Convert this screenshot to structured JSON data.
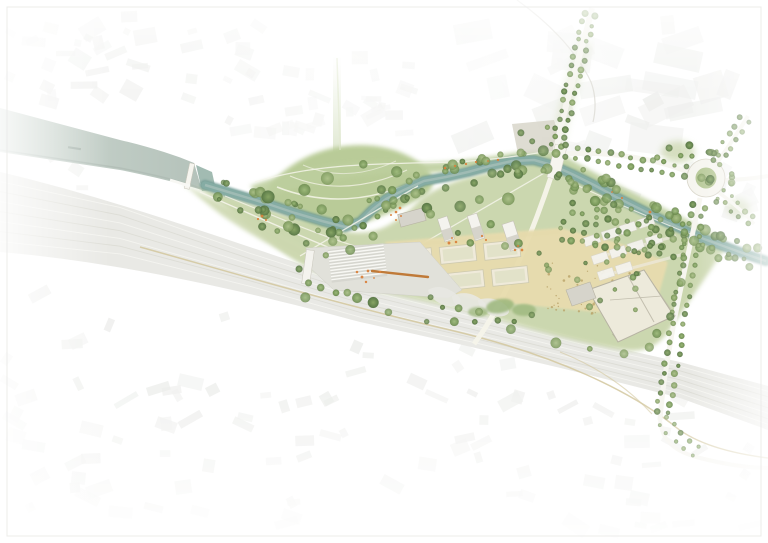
{
  "plan": {
    "kind": "landscape-masterplan",
    "features": [
      {
        "name": "city-fabric",
        "fill_key": "city_block"
      },
      {
        "name": "wide-canal",
        "fill_key": "canal_water"
      },
      {
        "name": "weir-lock-gate",
        "fill_key": "road"
      },
      {
        "name": "river",
        "fill_key": "river_core"
      },
      {
        "name": "river-bank-trees",
        "fill_key": "tree_mid"
      },
      {
        "name": "park-meadow",
        "fill_key": "park_green"
      },
      {
        "name": "event-lawn-with-arc-paths",
        "fill_key": "lawn_green"
      },
      {
        "name": "railway-corridor",
        "fill_key": "rail_band"
      },
      {
        "name": "plaza-with-grandstand-steps",
        "fill_key": "plaza"
      },
      {
        "name": "sand-area-with-courts",
        "fill_key": "sand"
      },
      {
        "name": "sports-courts",
        "fill_key": "court_fill"
      },
      {
        "name": "scatter-grove",
        "fill_key": "sand_dot"
      },
      {
        "name": "sports-hall",
        "fill_key": "building_fill"
      },
      {
        "name": "pavilion-buildings",
        "fill_key": "building_white"
      },
      {
        "name": "parking-rows",
        "fill_key": "building_white"
      },
      {
        "name": "orchard-grid",
        "fill_key": "tree_light"
      },
      {
        "name": "skatepark-landforms",
        "fill_key": "skate"
      },
      {
        "name": "bridge",
        "fill_key": "road"
      },
      {
        "name": "tree-lined-avenues",
        "fill_key": "road"
      },
      {
        "name": "roundabout",
        "fill_key": "roundabout_green"
      },
      {
        "name": "orange-furniture-accents",
        "fill_key": "orange"
      }
    ]
  },
  "palette": {
    "bg": "#ffffff",
    "city_block": "#e4e5e1",
    "city_block_dark": "#dcded9",
    "wash": "#ffffff",
    "canal_water": "#bfcbc4",
    "canal_edge": "#a9b7af",
    "river_deep": "#6f9a93",
    "river_core": "#85aca4",
    "river_light": "#a9c2ba",
    "park_green": "#c9d5ab",
    "lawn_green": "#b6c993",
    "bank_green": "#cdd8b0",
    "north_bank_green": "#bdcf9e",
    "tree_dark": "#587845",
    "tree_mid": "#6d8d50",
    "tree_light": "#8aa76c",
    "sand": "#e8dcae",
    "sand_dot": "#b9a268",
    "court_border": "#efeada",
    "court_fill": "#dfe0c4",
    "court_line": "#cdc9ae",
    "plaza": "#e1e1da",
    "plaza_dark": "#d6d6cf",
    "stair_line": "#f8f8f4",
    "building_fill": "#edeadb",
    "building_stroke": "#b7b3a3",
    "building_grey": "#d6d4cb",
    "building_white": "#f4f3ee",
    "shadow": "#96937f",
    "rail_band": "#e9e9e5",
    "rail_line_light": "#f5f5f1",
    "rail_line_dark": "#dcdbd4",
    "road": "#f6f5ef",
    "road_edge": "#d9d6ca",
    "road_tan": "#d2c79d",
    "roundabout_green": "#b5c794",
    "path": "#f5f4ea",
    "lawn_arc": "#eef0df",
    "arc_line": "#dcdbd4",
    "mound_green": "#9cb77c",
    "skate": "#e8e8e2",
    "forecourt": "#d8d6ca",
    "orange": "#d9813c",
    "orange_deep": "#c07a38"
  }
}
